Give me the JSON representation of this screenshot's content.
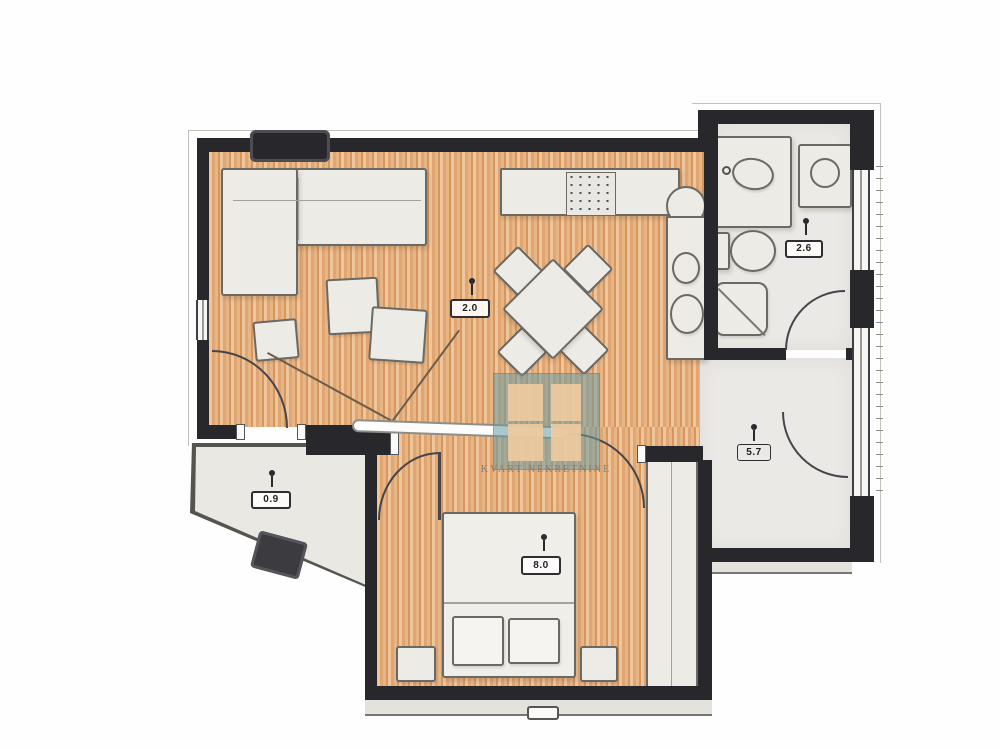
{
  "watermark": {
    "brand": "KVART NEKRETNINE",
    "logo_color": "#6a9aa3"
  },
  "rooms": {
    "living_dining": {
      "area_label": "2.0"
    },
    "bathroom": {
      "area_label": "2.6"
    },
    "bedroom": {
      "area_label": "8.0"
    },
    "hallway": {
      "area_label": "5.7"
    },
    "terrace": {
      "area_label": "0.9"
    }
  },
  "palette": {
    "wood_floor": "#e2a977",
    "wall": "#27272c",
    "tile_floor": "#ebe9e5",
    "furniture": "#edebe5",
    "watermark_teal": "#6a9aa3"
  }
}
